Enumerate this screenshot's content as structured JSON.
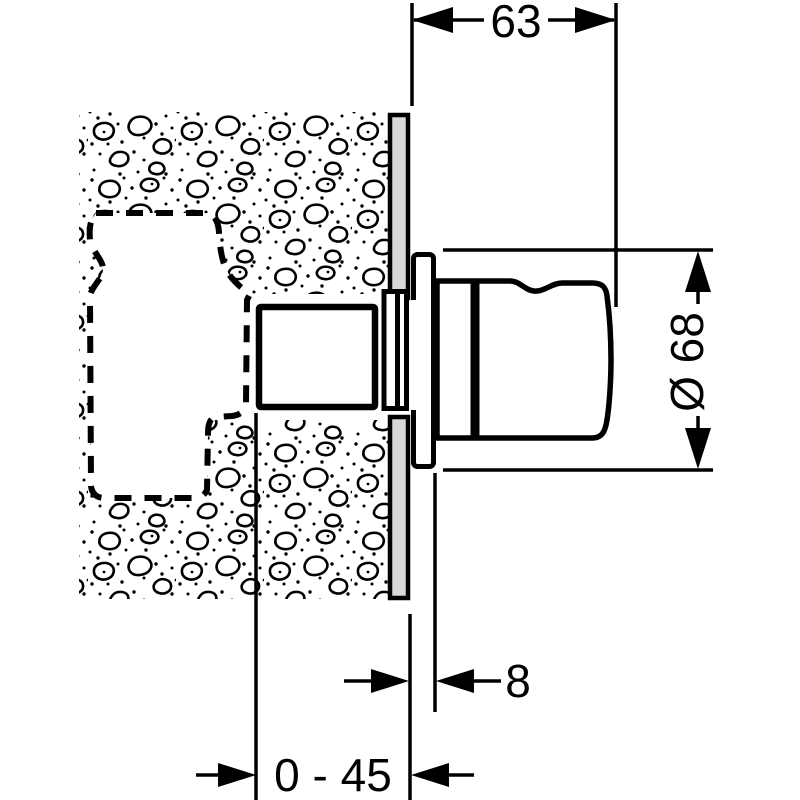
{
  "drawing": {
    "labels": {
      "width": "63",
      "diameter": "Ø 68",
      "sleeve_depth": "8",
      "adjust_range": "0 - 45"
    },
    "colors": {
      "line": "#000000",
      "plate_fill": "#d8d8d8",
      "background": "#ffffff"
    },
    "components": {
      "wall": "finished-wall-cross-section",
      "recess": "installation-recess-dashed",
      "valve": "concealed-valve-body",
      "stem": "valve-stem-sleeve",
      "plate": "wall-mounting-plate",
      "escutcheon": "escutcheon-sleeve",
      "handle": "shut-off-handle"
    }
  }
}
